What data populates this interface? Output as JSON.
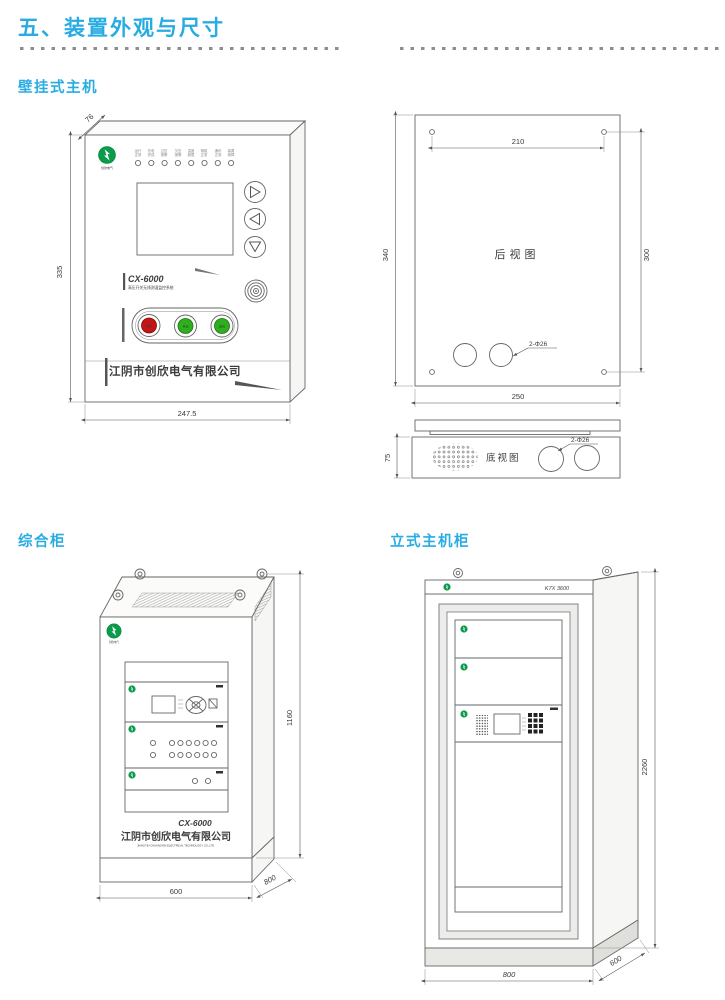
{
  "page": {
    "title": "五、装置外观与尺寸"
  },
  "sections": {
    "wall": "壁挂式主机",
    "cabinet": "综合柜",
    "vertical": "立式主机柜"
  },
  "wall_front": {
    "dim_depth": "76",
    "dim_height": "335",
    "dim_width": "247.5",
    "model": "CX-6000",
    "model_sub": "高压开关无线测温监控系统",
    "led_labels": [
      "运行 正常",
      "充电 完成",
      "过压 报警",
      "欠压 报警",
      "温度 超限",
      "储能 正常",
      "通讯 正常",
      "装置 故障"
    ],
    "button_labels": [
      "电源",
      "手动",
      "蜂鸣"
    ],
    "company": "江阴市创欣电气有限公司"
  },
  "wall_rear": {
    "title": "后视图",
    "dim_top": "210",
    "dim_height": "340",
    "dim_holes": "300",
    "dim_width": "250",
    "holes_note": "2-Φ26"
  },
  "wall_bottom": {
    "title": "底视图",
    "dim_height": "75",
    "holes_note": "2-Φ26"
  },
  "cabinet": {
    "dim_height": "1160",
    "dim_width": "600",
    "dim_depth": "800",
    "model": "CX-6000",
    "company": "江阴市创欣电气有限公司",
    "company_en": "JIANGYIN CHUANGXIN ELECTRICAL TECHNOLOGY CO.,LTD."
  },
  "vertical": {
    "model": "K7X 3600",
    "dim_height": "2260",
    "dim_width": "800",
    "dim_depth": "600"
  }
}
